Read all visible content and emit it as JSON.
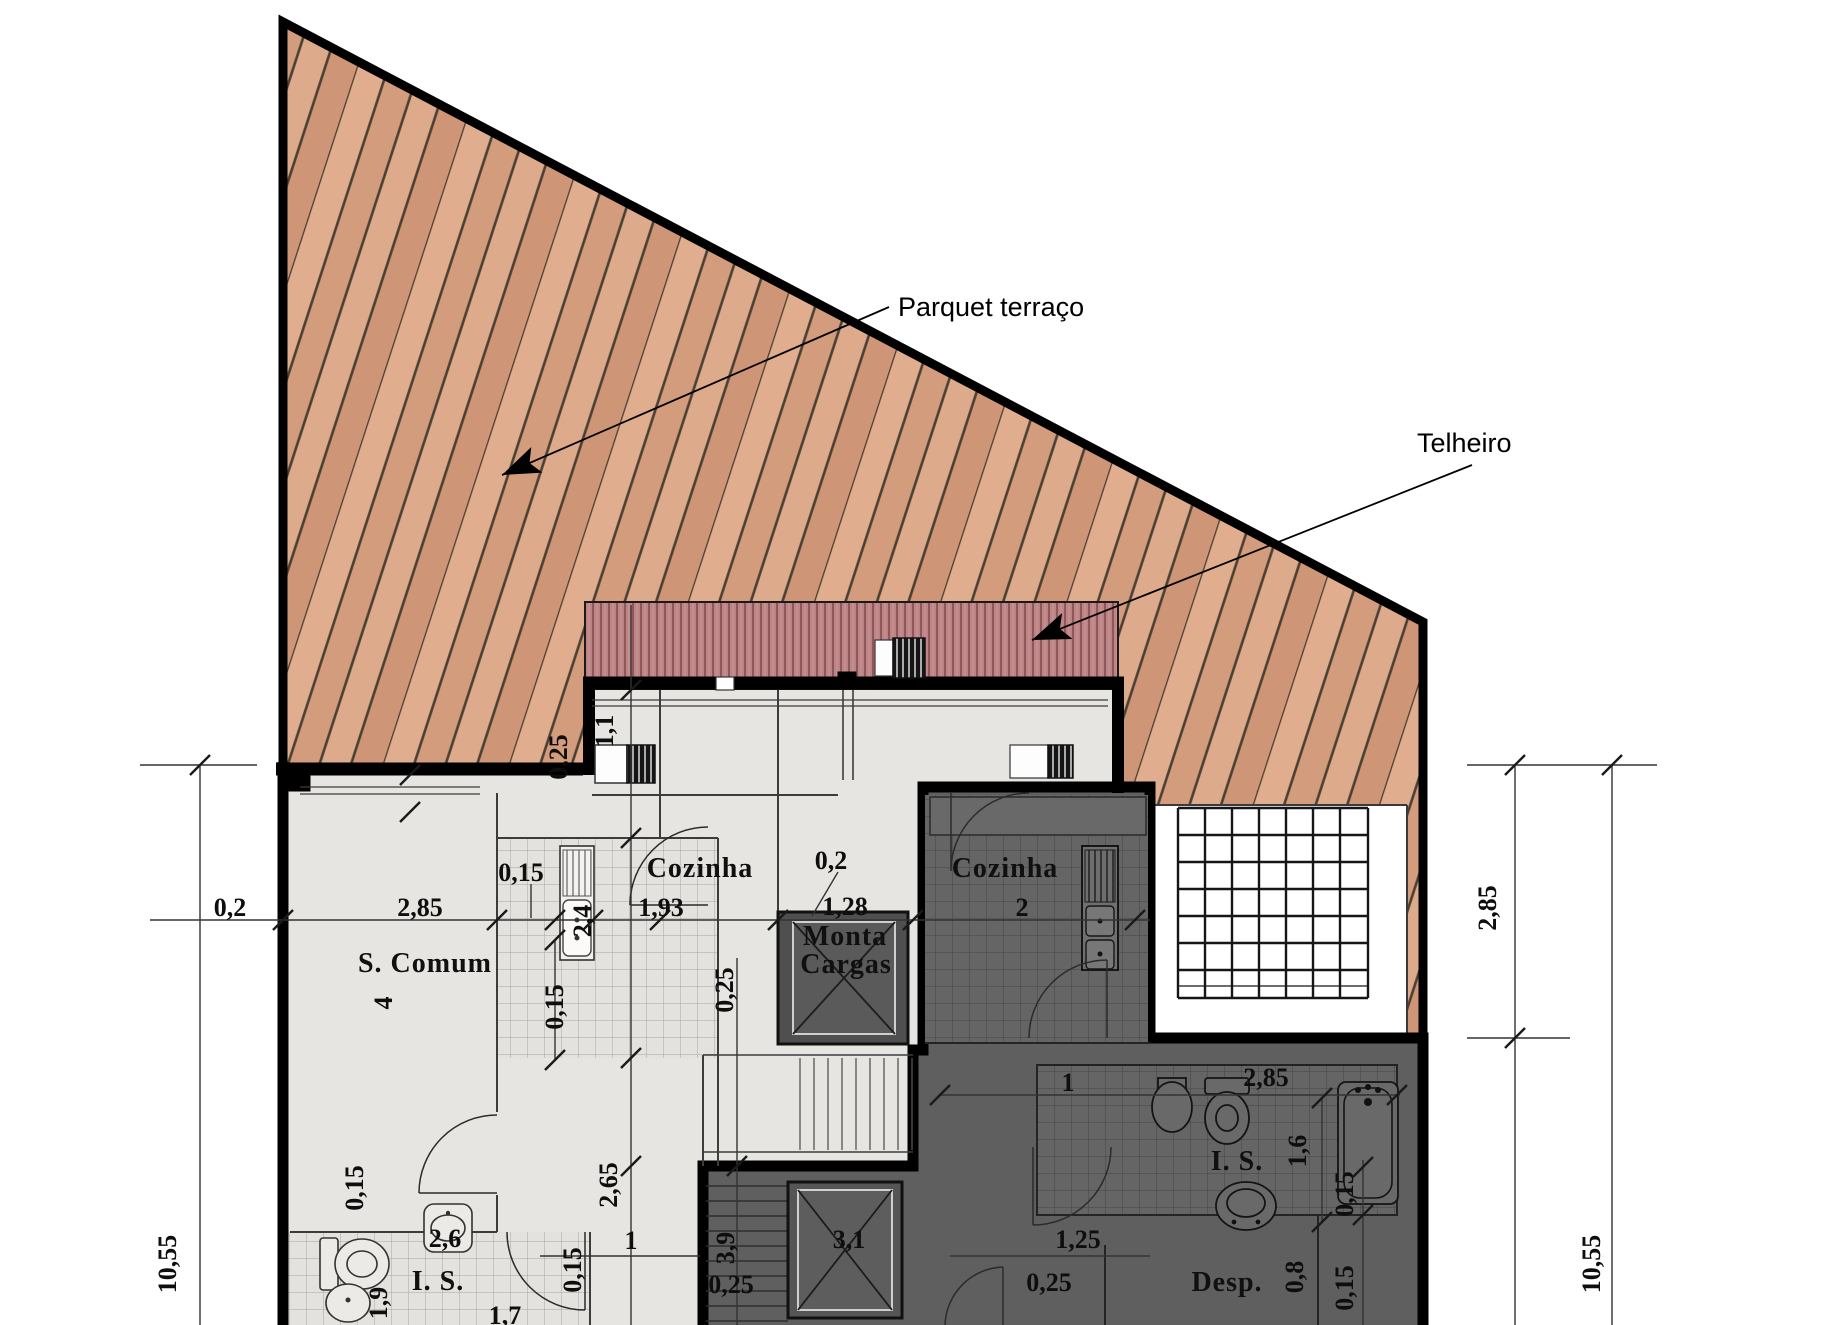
{
  "title": "Planta - piso com terraço (Parquet terraço / Telheiro)",
  "annotations": [
    {
      "text": "Parquet terraço",
      "x": 898,
      "y": 316
    },
    {
      "text": "Telheiro",
      "x": 1417,
      "y": 452
    }
  ],
  "room_labels": [
    {
      "text": "S. Comum",
      "x": 425,
      "y": 972,
      "size": 29
    },
    {
      "text": "Cozinha",
      "x": 700,
      "y": 877,
      "size": 28
    },
    {
      "text": "Cozinha",
      "x": 1005,
      "y": 877,
      "size": 28
    },
    {
      "text": "Monta",
      "x": 845,
      "y": 945,
      "size": 27
    },
    {
      "text": "Cargas",
      "x": 846,
      "y": 973,
      "size": 27
    },
    {
      "text": "I. S.",
      "x": 438,
      "y": 1290,
      "size": 28
    },
    {
      "text": "I. S.",
      "x": 1237,
      "y": 1170,
      "size": 28
    },
    {
      "text": "Desp.",
      "x": 1227,
      "y": 1291,
      "size": 28
    }
  ],
  "dimension_labels": [
    {
      "text": "0,2",
      "x": 230,
      "y": 916,
      "rot": 0
    },
    {
      "text": "2,85",
      "x": 420,
      "y": 916,
      "rot": 0
    },
    {
      "text": "0,15",
      "x": 521,
      "y": 881,
      "rot": 0
    },
    {
      "text": "1,93",
      "x": 661,
      "y": 916,
      "rot": 0
    },
    {
      "text": "0,2",
      "x": 831,
      "y": 869,
      "rot": 0
    },
    {
      "text": "1,28",
      "x": 845,
      "y": 915,
      "rot": 0
    },
    {
      "text": "2",
      "x": 1022,
      "y": 916,
      "rot": 0
    },
    {
      "text": "1",
      "x": 1068,
      "y": 1091,
      "rot": 0
    },
    {
      "text": "2,85",
      "x": 1266,
      "y": 1086,
      "rot": 0
    },
    {
      "text": "1,25",
      "x": 1078,
      "y": 1248,
      "rot": 0
    },
    {
      "text": "0,25",
      "x": 1049,
      "y": 1291,
      "rot": 0
    },
    {
      "text": "1",
      "x": 631,
      "y": 1249,
      "rot": 0
    },
    {
      "text": "0,25",
      "x": 731,
      "y": 1293,
      "rot": 0
    },
    {
      "text": "3,1",
      "x": 849,
      "y": 1248,
      "rot": 0
    },
    {
      "text": "2,6",
      "x": 445,
      "y": 1247,
      "rot": 0
    },
    {
      "text": "1,7",
      "x": 505,
      "y": 1324,
      "rot": 0
    },
    {
      "text": "1,1",
      "x": 613,
      "y": 731,
      "rot": 1
    },
    {
      "text": "0,25",
      "x": 567,
      "y": 757,
      "rot": 1,
      "color": "#7a4a28"
    },
    {
      "text": "2,4",
      "x": 591,
      "y": 921,
      "rot": 1
    },
    {
      "text": "0,15",
      "x": 563,
      "y": 1007,
      "rot": 1
    },
    {
      "text": "0,25",
      "x": 733,
      "y": 990,
      "rot": 1
    },
    {
      "text": "0,15",
      "x": 363,
      "y": 1188,
      "rot": 1
    },
    {
      "text": "2,65",
      "x": 617,
      "y": 1185,
      "rot": 1
    },
    {
      "text": "0,15",
      "x": 581,
      "y": 1270,
      "rot": 1
    },
    {
      "text": "1,9",
      "x": 387,
      "y": 1303,
      "rot": 1
    },
    {
      "text": "3,9",
      "x": 734,
      "y": 1248,
      "rot": 1
    },
    {
      "text": "1,6",
      "x": 1306,
      "y": 1151,
      "rot": 1
    },
    {
      "text": "0,15",
      "x": 1353,
      "y": 1194,
      "rot": 1
    },
    {
      "text": "0,8",
      "x": 1303,
      "y": 1277,
      "rot": 1
    },
    {
      "text": "0,15",
      "x": 1353,
      "y": 1288,
      "rot": 1
    },
    {
      "text": "2,85",
      "x": 1496,
      "y": 908,
      "rot": 1
    },
    {
      "text": "10,55",
      "x": 1600,
      "y": 1264,
      "rot": 1
    },
    {
      "text": "10,55",
      "x": 176,
      "y": 1264,
      "rot": 1
    },
    {
      "text": "4",
      "x": 392,
      "y": 1003,
      "rot": 1
    }
  ],
  "dimension_lines": [
    [
      140,
      765,
      257,
      765
    ],
    [
      200,
      765,
      200,
      1325
    ],
    [
      1467,
      765,
      1657,
      765
    ],
    [
      1515,
      765,
      1515,
      1325
    ],
    [
      1612,
      765,
      1612,
      1325
    ],
    [
      1467,
      1038,
      1570,
      1038
    ],
    [
      150,
      920,
      1150,
      920
    ],
    [
      631,
      605,
      631,
      1325
    ],
    [
      737,
      958,
      737,
      1325
    ],
    [
      555,
      940,
      555,
      1060
    ],
    [
      940,
      1095,
      1400,
      1095
    ],
    [
      1322,
      1098,
      1322,
      1222
    ],
    [
      1363,
      1160,
      1363,
      1325
    ],
    [
      950,
      1256,
      1150,
      1256
    ],
    [
      540,
      1256,
      700,
      1256
    ],
    [
      531,
      884,
      531,
      918
    ],
    [
      838,
      872,
      812,
      916
    ]
  ],
  "dimension_ticks": [
    [
      200,
      765
    ],
    [
      1515,
      765
    ],
    [
      1612,
      765
    ],
    [
      1515,
      1038
    ],
    [
      283,
      920
    ],
    [
      497,
      920
    ],
    [
      555,
      920
    ],
    [
      593,
      920
    ],
    [
      660,
      920
    ],
    [
      778,
      920
    ],
    [
      913,
      920
    ],
    [
      1135,
      920
    ],
    [
      631,
      690
    ],
    [
      631,
      838
    ],
    [
      631,
      1058
    ],
    [
      631,
      1166
    ],
    [
      737,
      1166
    ],
    [
      940,
      1095
    ],
    [
      1397,
      1095
    ],
    [
      1322,
      1098
    ],
    [
      1322,
      1222
    ],
    [
      1363,
      1167
    ],
    [
      1363,
      1215
    ],
    [
      555,
      940
    ],
    [
      555,
      1060
    ],
    [
      410,
      775
    ],
    [
      410,
      812
    ]
  ],
  "colors": {
    "wood_base": "#d9a284",
    "wood_line": "#4a3f33",
    "roof_base": "#bd8385",
    "roof_stripe": "#8e585b",
    "light_floor": "#e7e5e2",
    "dark_floor": "#5f5f5f",
    "wall": "#000000",
    "dim_brown": "#7a4a28"
  }
}
